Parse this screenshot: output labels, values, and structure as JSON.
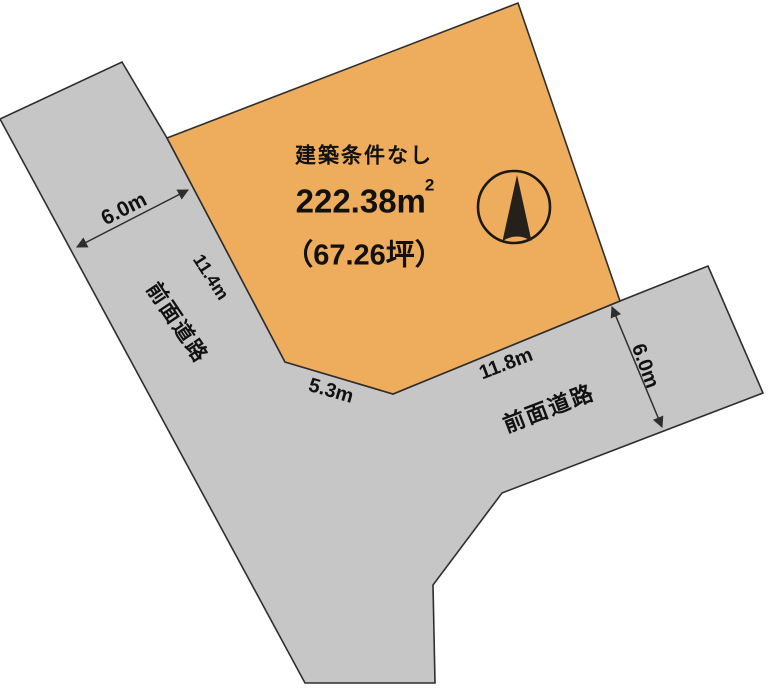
{
  "plot": {
    "condition": "建築条件なし",
    "area_sqm": "222.38m",
    "area_sqm_exponent": "2",
    "area_tsubo": "（67.26坪）"
  },
  "roads": {
    "left": {
      "name": "前面道路",
      "width": "6.0m"
    },
    "right": {
      "name": "前面道路",
      "width": "6.0m"
    }
  },
  "frontage": {
    "left_edge": "11.4m",
    "bottom_left_edge": "5.3m",
    "bottom_edge": "11.8m"
  },
  "icons": {
    "north_arrow": "north-arrow-icon"
  },
  "colors": {
    "plot_fill": "#edad5c",
    "road_fill": "#c6c6c6",
    "line": "#2e2e2e",
    "text": "#111111"
  }
}
